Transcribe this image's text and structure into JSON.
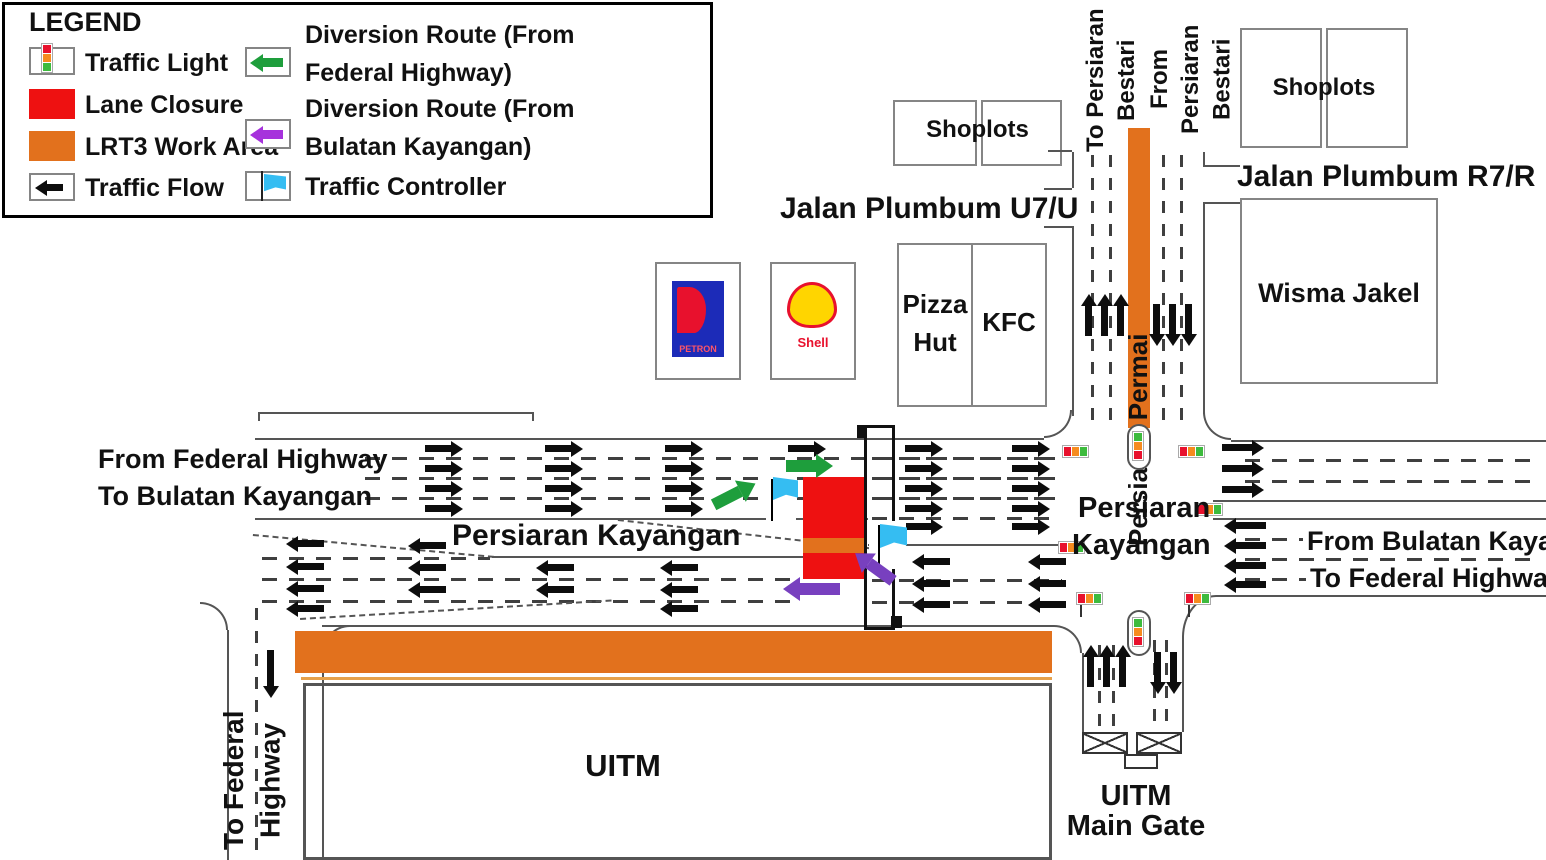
{
  "legend": {
    "title": "LEGEND",
    "traffic_light": "Traffic Light",
    "lane_closure": "Lane Closure",
    "lrt3_work_area": "LRT3 Work Area",
    "traffic_flow": "Traffic Flow",
    "diversion_federal_line1": "Diversion Route (From",
    "diversion_federal_line2": "Federal Highway)",
    "diversion_bulatan_line1": "Diversion Route (From",
    "diversion_bulatan_line2": "Bulatan Kayangan)",
    "traffic_controller": "Traffic Controller"
  },
  "buildings": {
    "shoplots_top": "Shoplots",
    "shoplots_right": "Shoplots",
    "wisma_jakel": "Wisma Jakel",
    "pizza_line1": "Pizza",
    "pizza_line2": "Hut",
    "kfc": "KFC",
    "petron": "PETRON",
    "shell": "Shell",
    "uitm": "UITM",
    "uitm_gate_line1": "UITM",
    "uitm_gate_line2": "Main Gate"
  },
  "roads": {
    "jalan_plumbum_u7u": "Jalan Plumbum U7/U",
    "jalan_plumbum_r7r": "Jalan Plumbum R7/R",
    "persiaran_permai": "Persiaran Permai",
    "persiaran_kayangan": "Persiaran Kayangan",
    "persiaran_kayangan_line1": "Persiaran",
    "persiaran_kayangan_line2": "Kayangan",
    "to_persiaran_bestari_line1": "To Persiaran",
    "to_persiaran_bestari_line2": "Bestari",
    "from_persiaran_bestari_line1": "From Persiaran",
    "from_persiaran_bestari_line2": "Bestari",
    "from_federal_highway": "From Federal Highway",
    "to_bulatan_kayangan": "To Bulatan Kayangan",
    "from_bulatan_kayangan": "From Bulatan Kayangan",
    "to_federal_highway": "To Federal Highway",
    "to_federal_highway_v_line1": "To Federal",
    "to_federal_highway_v_line2": "Highway"
  },
  "colors": {
    "lane_closure": "#EE1111",
    "lrt3_work_area": "#E2711D",
    "diversion_federal_arrow": "#1E9E3C",
    "diversion_bulatan_arrow_legend": "#A632DC",
    "diversion_bulatan_arrow_map": "#7840BF",
    "traffic_controller_flag": "#35BDF2",
    "traffic_light_red": "#E8112D",
    "traffic_light_orange": "#F68B1F",
    "traffic_light_green": "#3DBB3D"
  }
}
